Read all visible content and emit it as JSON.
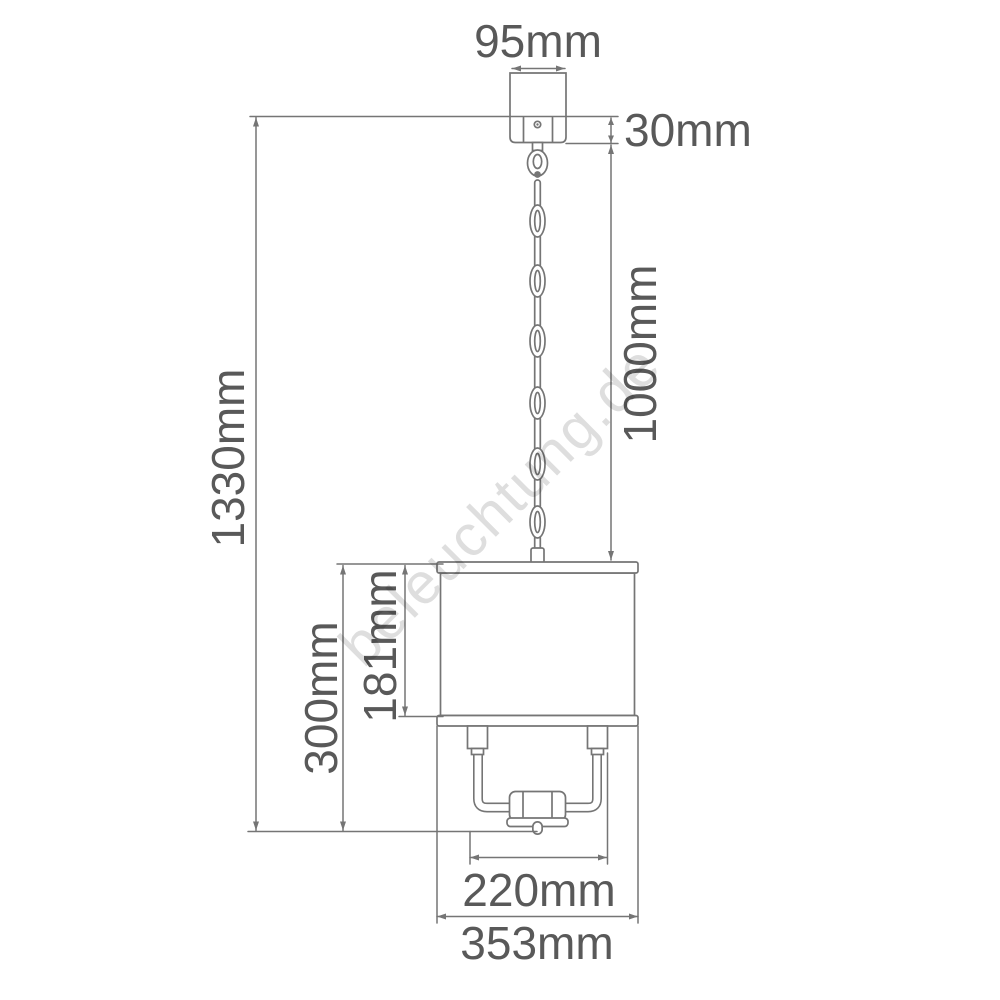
{
  "diagram": {
    "description": "Pendant lamp dimension drawing",
    "labels": {
      "canopy_width": "95mm",
      "canopy_height": "30mm",
      "chain_length": "1000mm",
      "total_height": "1330mm",
      "shade_height": "181mm",
      "body_height": "300mm",
      "frame_width": "220mm",
      "shade_width": "353mm"
    },
    "colors": {
      "line": "#757575",
      "label_text": "#595959",
      "watermark": "#dedede",
      "background": "#ffffff"
    }
  },
  "watermark": {
    "text": "beleuchtung.de"
  }
}
